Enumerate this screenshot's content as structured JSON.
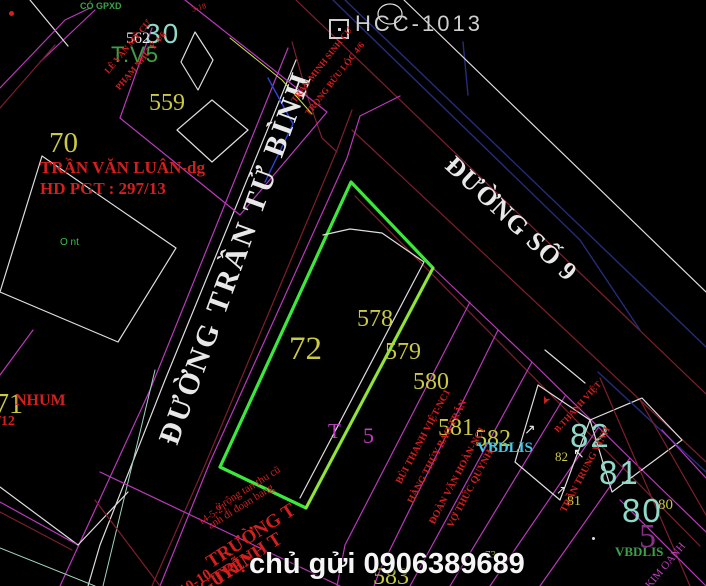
{
  "colors": {
    "bg": "#000000",
    "yellow": "#c9c943",
    "red": "#d41f1f",
    "darkred": "#7d1f2e",
    "magenta": "#bb39bb",
    "magenta-text": "#c040c0",
    "dim-magenta": "#8a2f8a",
    "navy": "#252c78",
    "white-line": "#dedede",
    "white-text": "#e8e8e8",
    "cad-white": "#cfcfcf",
    "green": "#3ce83c",
    "green-bright": "#38c048",
    "green-text": "#3aa34a",
    "yellowgreen": "#a6dc38",
    "teal": "#8fd9c9",
    "cyan": "#45c8e6",
    "blue": "#3042d8",
    "pale": "#9fd4be",
    "chartreuse": "#c6e34a"
  },
  "texts": {
    "code": "HCC-1013",
    "watermark": "chủ gửi 0906389689",
    "street_tran_tu_binh": "ĐƯỜNG TRẦN TỬ BÌNH",
    "street_so_9": "ĐƯỜNG SỐ 9",
    "n30": "30",
    "n562": "562",
    "tv5": "T.V5",
    "n559": "559",
    "n70": "70",
    "n71": "71",
    "n72": "72",
    "n578": "578",
    "n579": "579",
    "n580": "580",
    "n581": "581",
    "n582": "582",
    "n583": "583",
    "n73": "73",
    "b82": "82",
    "b81": "81",
    "b80": "80",
    "s82": "82",
    "s81": "81",
    "s80": "80",
    "vbdlis_cyan": "VBDLIS",
    "vbdlis_green": "VBDLIS",
    "co_gpxd": "CÓ GPXD",
    "o_nt": "O nt",
    "t_label": "T",
    "five_label": "5",
    "big5": "5",
    "kim_oanh": "KIM OANH",
    "owner_luan_1": "TRẦN VĂN LUÂN-dg",
    "owner_luan_2": "HD PGT : 297/13",
    "nhum": "NHUM",
    "hd12": "/12",
    "note_1": "ở rộng tan thu cũ",
    "note_2": "anh đi đoạn bang",
    "note_3": "14-5-21",
    "school_1": "TRƯỜNG T",
    "school_2": "TRỊNH T",
    "school_3": "NGUYỄN",
    "school_4": "10-10",
    "strip_1": "BÙI THANH VIỆT-NC1",
    "strip_2": "HÀNG THÚY BẢO TRÂN",
    "strip_3": "ĐOÀN VĂN HOÀN-NC1",
    "strip_4": "VỢ THỨC QUYNH",
    "owner_vinh": "TRẦN TRUNG VINH",
    "owner_82": "B.THANH VIỆT",
    "top_red_a1": "LÊ VĂN MỸ CƯ",
    "top_red_a2": "PHẠM NHƯ Ý 4/6",
    "top_red_b1": "TRẦN MINH SINH CƯ",
    "top_red_b2": "TRỌNG BỬU LỘC 4/6",
    "top_red_c": "3-18"
  },
  "icons": {
    "arrow_up_right": "↗",
    "arrow_up_left": "↖",
    "arrow_pointer": "➤"
  }
}
